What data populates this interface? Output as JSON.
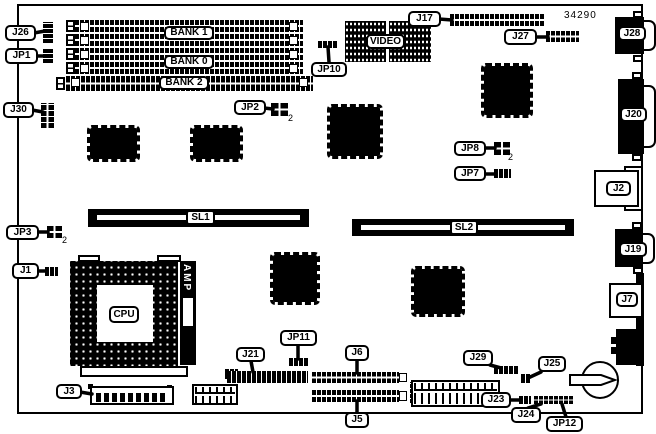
{
  "doc": {
    "part_number": "34290"
  },
  "colors": {
    "ink": "#000000",
    "paper": "#ffffff"
  },
  "labels": {
    "j26": "J26",
    "jp1": "JP1",
    "j30": "J30",
    "jp3": "JP3",
    "j1": "J1",
    "j3": "J3",
    "bank1": "BANK 1",
    "bank0": "BANK 0",
    "bank2": "BANK 2",
    "video": "VIDEO",
    "jp10": "JP10",
    "j17": "J17",
    "j27": "J27",
    "j28": "J28",
    "jp2": "JP2",
    "j20": "J20",
    "jp8": "JP8",
    "jp7": "JP7",
    "j2": "J2",
    "sl1": "SL1",
    "sl2": "SL2",
    "cpu": "CPU",
    "amp": "AMP",
    "j19": "J19",
    "j7": "J7",
    "j21": "J21",
    "jp11": "JP11",
    "j6": "J6",
    "j5": "J5",
    "j29": "J29",
    "j25": "J25",
    "j23": "J23",
    "j24": "J24",
    "jp12": "JP12"
  },
  "pin_annotations": {
    "jp2": "2",
    "jp3": "2",
    "jp8": "2"
  }
}
